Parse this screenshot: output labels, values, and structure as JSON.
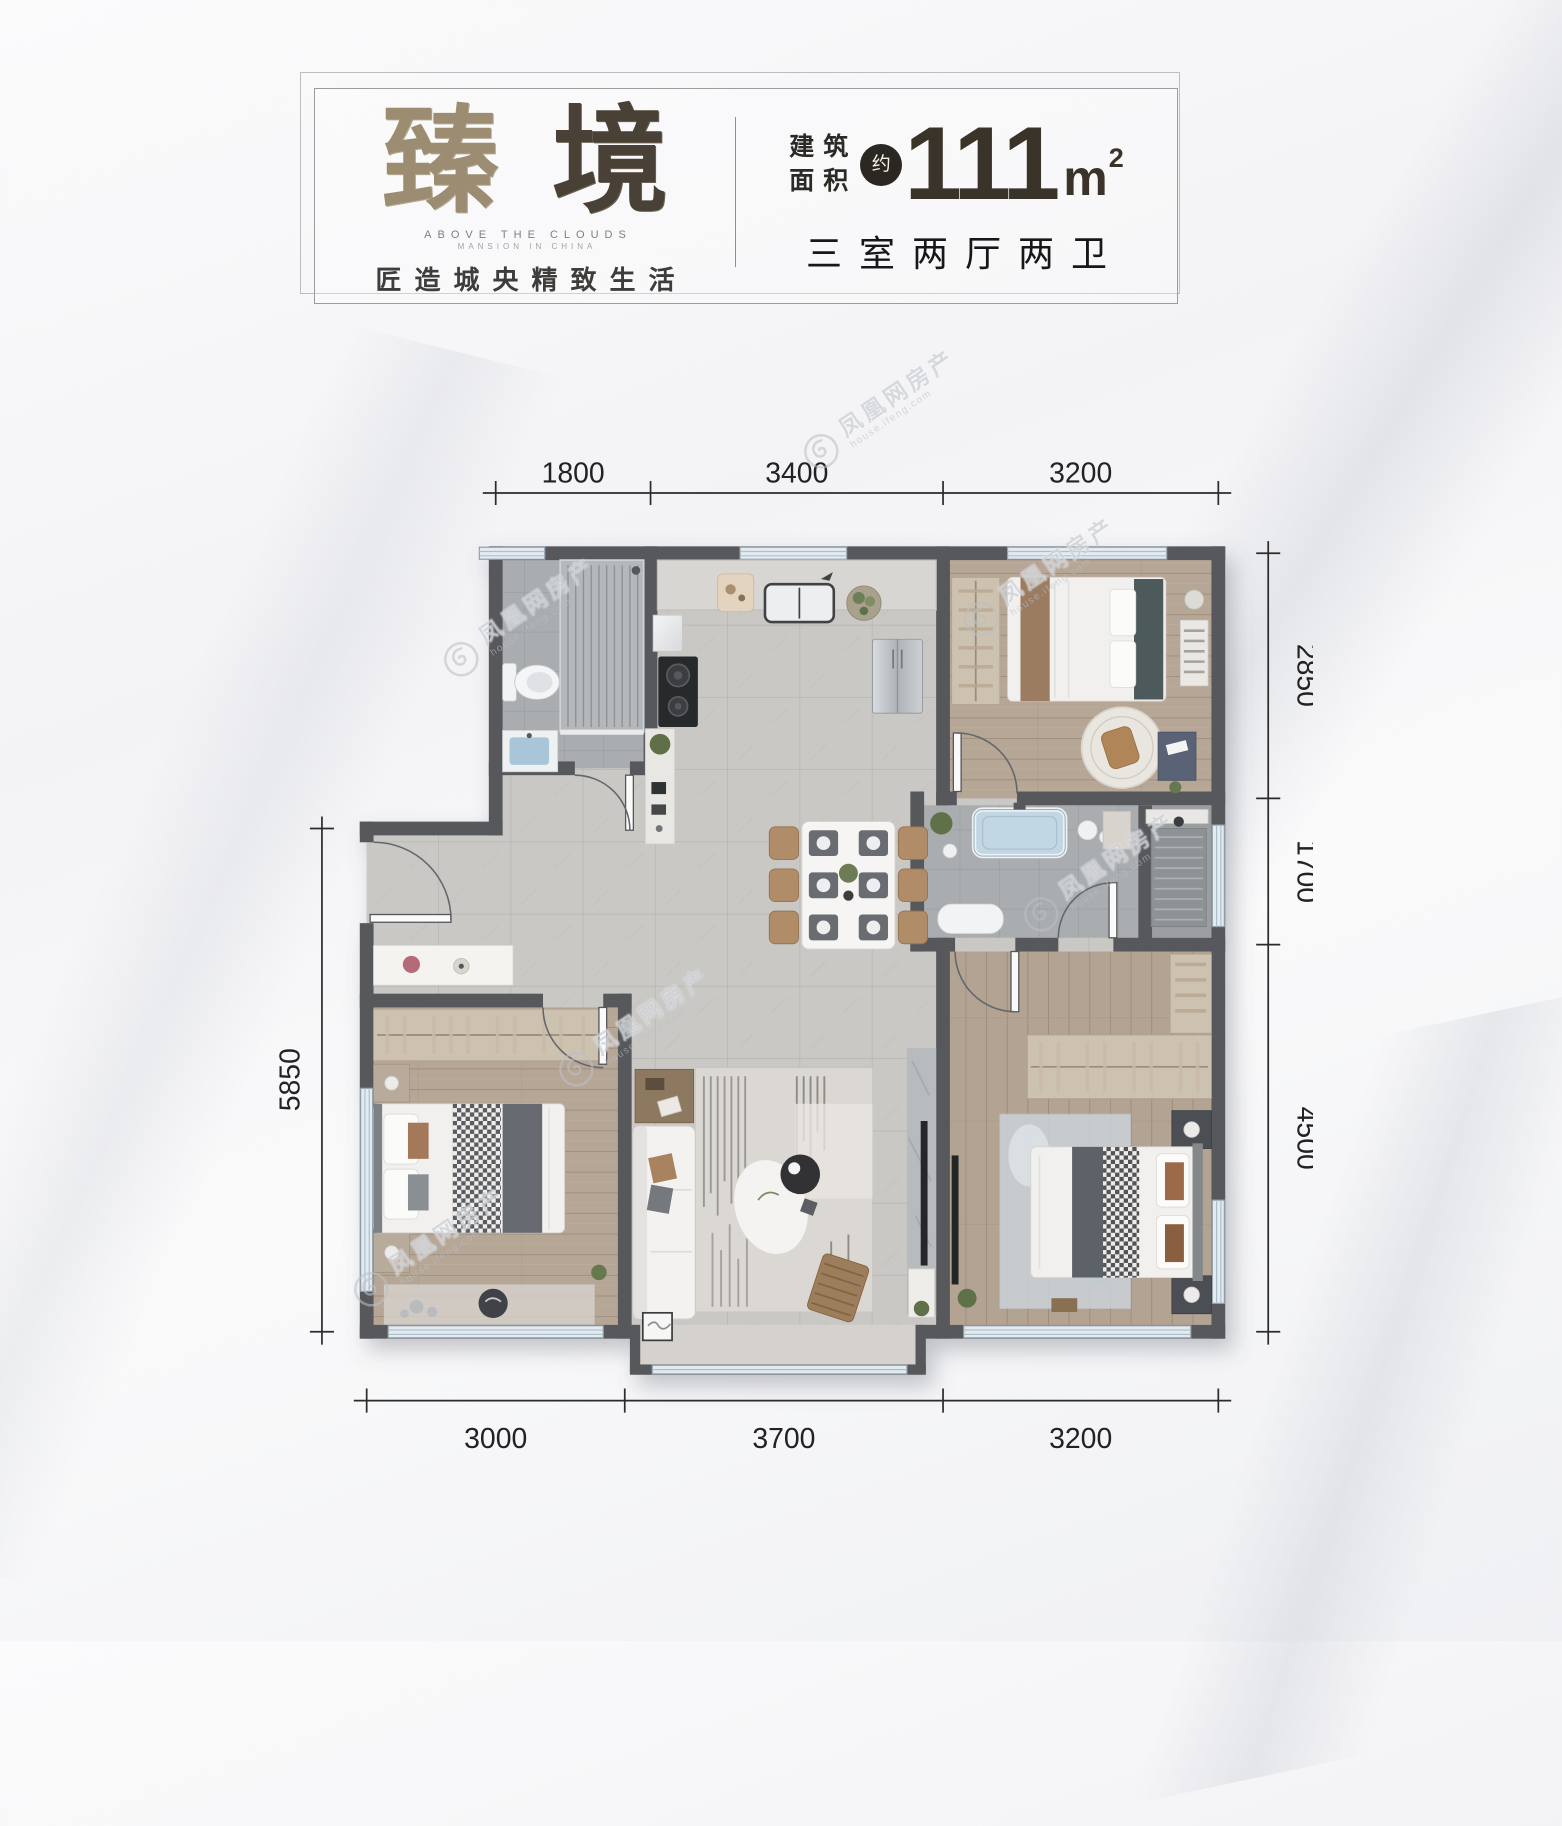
{
  "title_card": {
    "name_chars": [
      "臻",
      "境"
    ],
    "subtitle_en": "ABOVE THE CLOUDS",
    "subtitle_en2": "MANSION IN CHINA",
    "tagline": "匠造城央精致生活",
    "area_prefix_line1": "建筑",
    "area_prefix_line2": "面积",
    "area_approx_mark": "约",
    "area_value": "111",
    "area_unit_base": "m",
    "area_unit_exponent": "2",
    "layout_summary": "三室两厅两卫"
  },
  "floor_plan": {
    "dimensions_mm": {
      "top": [
        "1800",
        "3400",
        "3200"
      ],
      "right": [
        "2850",
        "1700",
        "4500"
      ],
      "left": [
        "5850"
      ],
      "bottom": [
        "3000",
        "3700",
        "3200"
      ]
    }
  },
  "watermark": {
    "text": "凤凰网房产",
    "subtext": "house.ifeng.com"
  },
  "colors": {
    "wall": "#57585b",
    "tile_floor": "#cac8c5",
    "wood_floor": "#b6a696",
    "bath_floor": "#a9adaf",
    "window": "#dde7ee",
    "dimension_ink": "#2b2b2d",
    "title_brown": "#4a4136"
  }
}
